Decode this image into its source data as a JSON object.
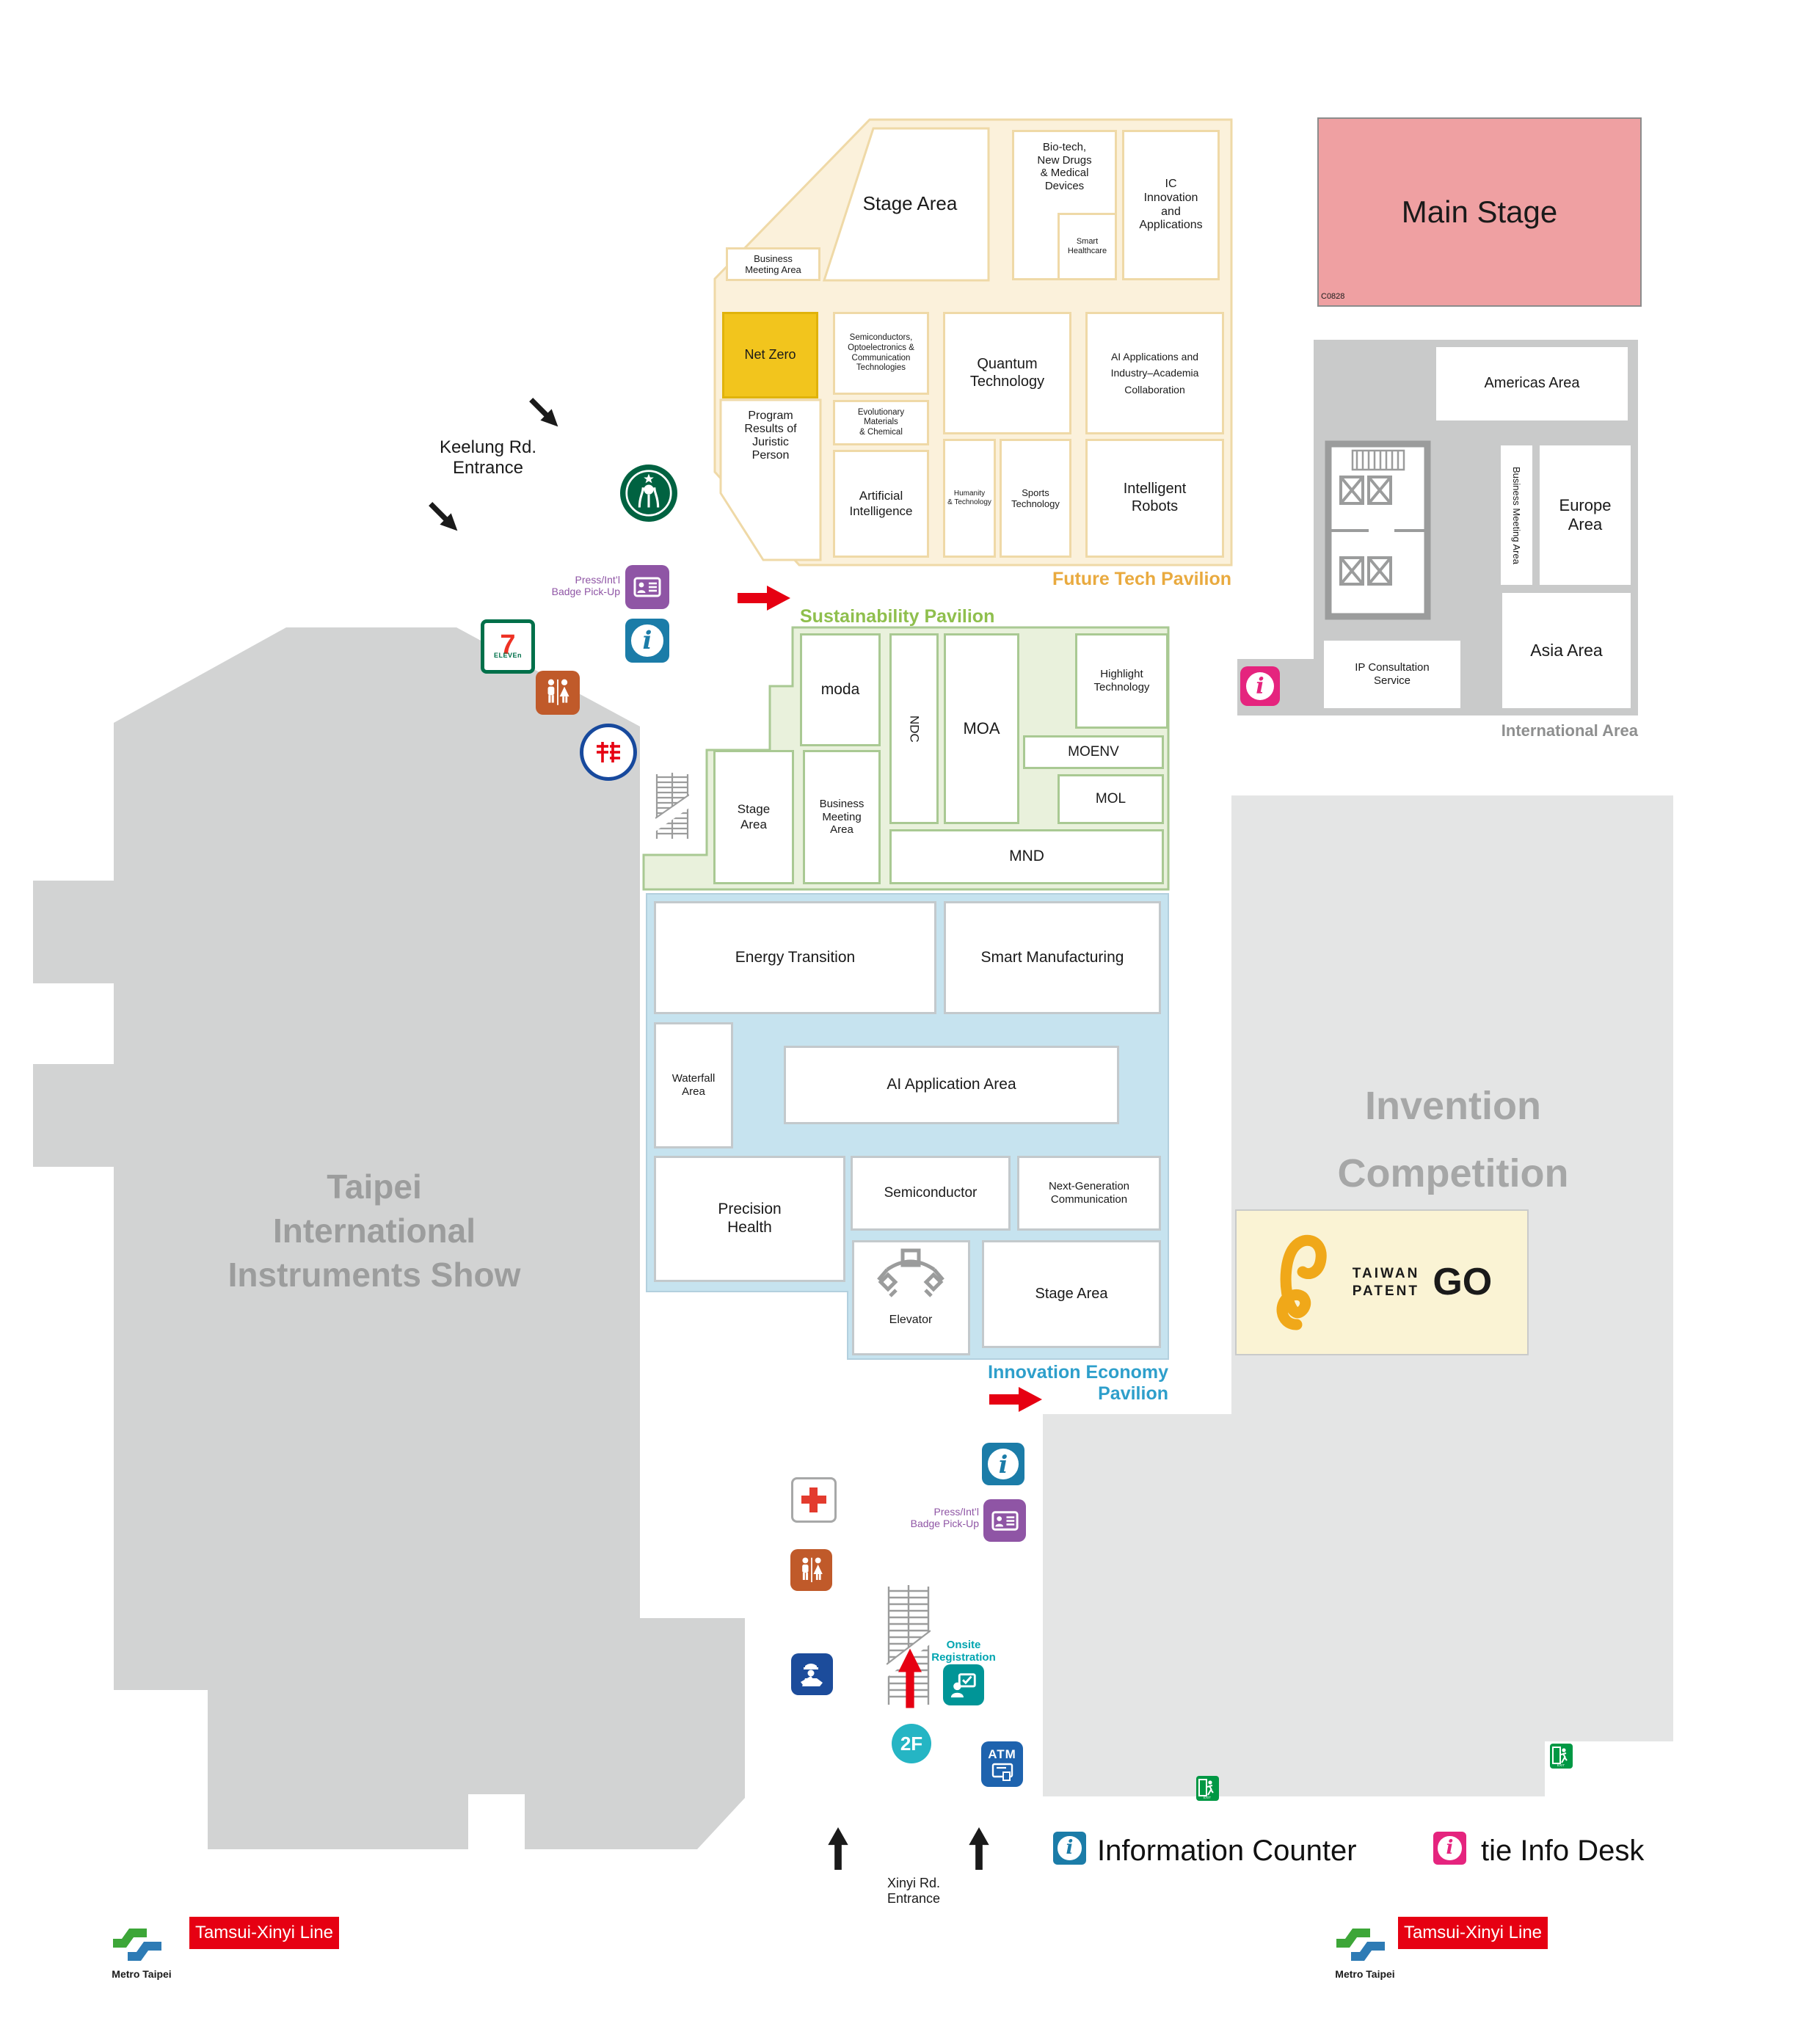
{
  "future_tech": {
    "label": "Future Tech Pavilion",
    "areas": {
      "stage": "Stage Area",
      "business_meeting": "Business\nMeeting Area",
      "bio_tech": "Bio-tech,\nNew Drugs\n& Medical\nDevices",
      "smart_healthcare": "Smart\nHealthcare",
      "ic_innovation": "IC\nInnovation\nand\nApplications",
      "net_zero": "Net Zero",
      "semiconductors": "Semiconductors,\nOptoelectronics &\nCommunication\nTechnologies",
      "quantum": "Quantum\nTechnology",
      "ai_industry": "AI Applications and\nIndustry–Academia\nCollaboration",
      "program_results": "Program\nResults of\nJuristic\nPerson",
      "evolutionary": "Evolutionary\nMaterials\n& Chemical",
      "artificial_intelligence": "Artificial\nIntelligence",
      "humanity": "Humanity\n& Technology",
      "sports": "Sports\nTechnology",
      "robots": "Intelligent\nRobots"
    }
  },
  "main_stage": {
    "label": "Main Stage",
    "booth_code": "C0828"
  },
  "international": {
    "label": "International Area",
    "areas": {
      "americas": "Americas Area",
      "business_meeting": "Business Meeting Area",
      "europe": "Europe\nArea",
      "asia": "Asia Area",
      "ip_consultation": "IP Consultation\nService"
    }
  },
  "sustainability": {
    "label": "Sustainability Pavilion",
    "areas": {
      "moda": "moda",
      "ndc": "NDC",
      "moa": "MOA",
      "highlight": "Highlight\nTechnology",
      "moenv": "MOENV",
      "mol": "MOL",
      "mnd": "MND",
      "stage": "Stage\nArea",
      "business_meeting": "Business\nMeeting\nArea"
    }
  },
  "innovation": {
    "label": "Innovation Economy Pavilion",
    "areas": {
      "energy": "Energy Transition",
      "smart_mfg": "Smart Manufacturing",
      "waterfall": "Waterfall\nArea",
      "ai_application": "AI Application Area",
      "precision": "Precision\nHealth",
      "semiconductor": "Semiconductor",
      "next_gen": "Next-Generation\nCommunication",
      "stage": "Stage Area",
      "elevator": "Elevator"
    }
  },
  "invention_competition": "Invention\nCompetition",
  "instruments_show": "Taipei\nInternational\nInstruments Show",
  "patent_go": {
    "line1": "TAIWAN",
    "line2": "PATENT",
    "go": "GO"
  },
  "services": {
    "badge_pickup": "Press/Int’l\nBadge Pick-Up",
    "onsite_registration": "Onsite\nRegistration",
    "floor": "2F",
    "atm": "ATM",
    "exit": "EXIT",
    "seven_digit": "7",
    "seven_word": "ELEVEn"
  },
  "entrances": {
    "keelung": "Keelung Rd.\nEntrance",
    "xinyi": "Xinyi Rd.\nEntrance"
  },
  "legend": {
    "information_counter": "Information Counter",
    "tie_info_desk": "tie Info Desk"
  },
  "transit": {
    "metro": "Metro Taipei",
    "line": "Tamsui-Xinyi Line"
  },
  "colors": {
    "future_fill": "#FBF1DB",
    "future_border": "#EFD9A7",
    "future_label": "#E9AA3F",
    "net_zero": "#F2C51D",
    "main_stage": "#EFA0A2",
    "green_fill": "#E9F1DC",
    "green_border": "#A9C993",
    "green_label": "#8FBF4D",
    "blue_fill": "#C6E3EF",
    "blue_label": "#2E9FCB",
    "gray_building": "#D2D3D3",
    "gray_light": "#E4E5E5",
    "gray_intl": "#C9CACA",
    "red": "#E60012",
    "teal": "#00A5B0",
    "purple": "#8F55A5",
    "info_blue": "#1B7CA8",
    "pink": "#E5247E",
    "exit_green": "#009844",
    "police_blue": "#1C4C9B",
    "restroom_orange": "#C05A2A",
    "atm_blue": "#1E63AE",
    "floor_teal": "#25B5C4",
    "patent_cream": "#FAF3D4",
    "patent_orange": "#F0A819"
  }
}
